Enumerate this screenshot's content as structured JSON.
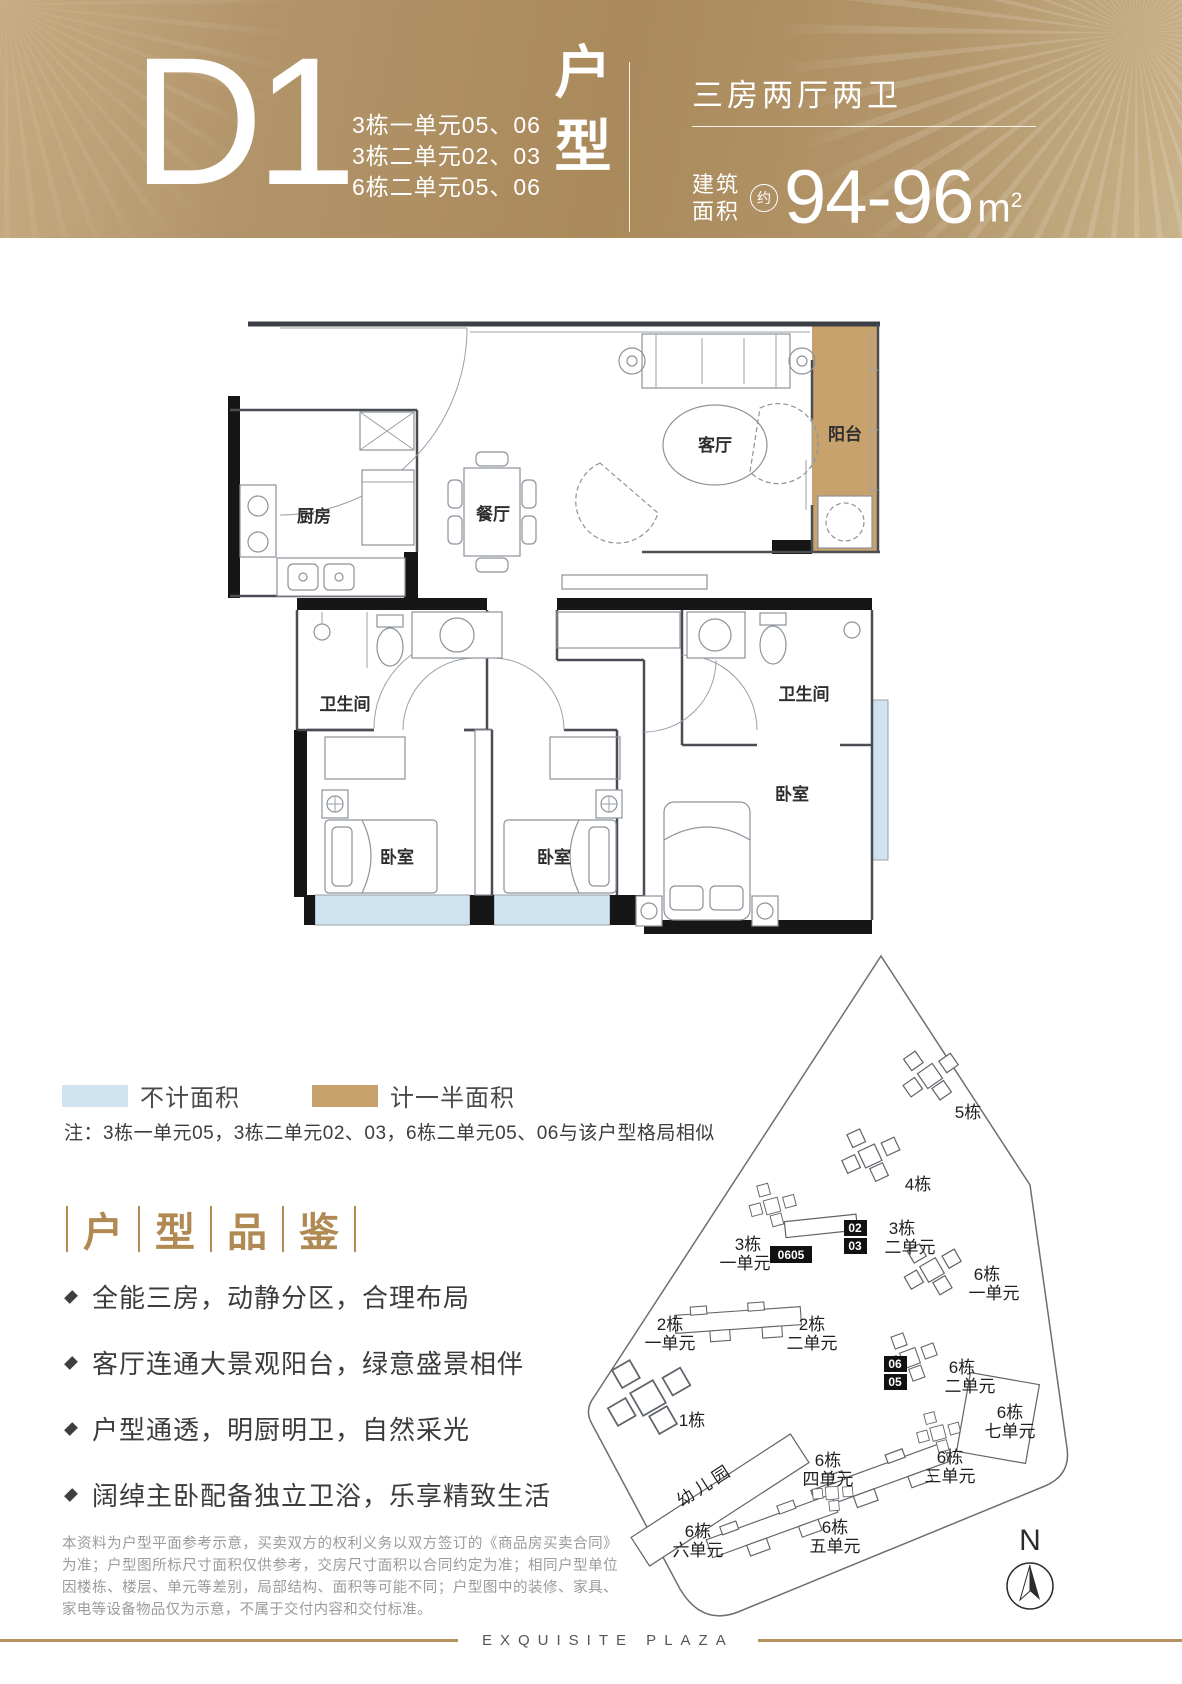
{
  "header": {
    "plan_code": "D1",
    "unit_lines": [
      "3栋一单元05、06",
      "3栋二单元02、03",
      "6栋二单元05、06"
    ],
    "category_char1": "户",
    "category_char2": "型",
    "layout_summary": "三房两厅两卫",
    "area_label_top": "建筑",
    "area_label_bottom": "面积",
    "area_circa": "约",
    "area_value": "94-96",
    "area_unit": "m",
    "area_sup": "2"
  },
  "colors": {
    "header_gold": "#b2946a",
    "legend_blue": "#cfe4f0",
    "legend_tan": "#c8a26c",
    "accent_gold_text": "#b08a52",
    "footer_line": "#b5915e"
  },
  "floor_plan": {
    "rooms": {
      "kitchen": "厨房",
      "dining": "餐厅",
      "living": "客厅",
      "balcony": "阳台",
      "bathroom": "卫生间",
      "bedroom": "卧室"
    }
  },
  "legend": {
    "items": [
      {
        "label": "不计面积",
        "color": "#cfe4f0"
      },
      {
        "label": "计一半面积",
        "color": "#c8a26c"
      }
    ],
    "note": "注：3栋一单元05，3栋二单元02、03，6栋二单元05、06与该户型格局相似"
  },
  "highlights": {
    "chars": [
      "户",
      "型",
      "品",
      "鉴"
    ],
    "bullets": [
      "全能三房，动静分区，合理布局",
      "客厅连通大景观阳台，绿意盛景相伴",
      "户型通透，明厨明卫，自然采光",
      "阔绰主卧配备独立卫浴，乐享精致生活"
    ]
  },
  "disclaimer": {
    "text": "本资料为户型平面参考示意，买卖双方的权利义务以双方签订的《商品房买卖合同》为准；户型图所标尺寸面积仅供参考，交房尺寸面积以合同约定为准；相同户型单位因楼栋、楼层、单元等差别，局部结构、面积等可能不同；户型图中的装修、家具、家电等设备物品仅为示意，不属于交付内容和交付标准。"
  },
  "site_map": {
    "labels": [
      {
        "building": "5栋",
        "unit": ""
      },
      {
        "building": "4栋",
        "unit": ""
      },
      {
        "building": "3栋",
        "unit": "一单元",
        "badge": "0605"
      },
      {
        "building": "3栋",
        "unit": "二单元",
        "badge_top": "02",
        "badge_bottom": "03"
      },
      {
        "building": "6栋",
        "unit": "一单元"
      },
      {
        "building": "2栋",
        "unit": "一单元"
      },
      {
        "building": "2栋",
        "unit": "二单元"
      },
      {
        "building": "6栋",
        "unit": "二单元",
        "badge_top": "06",
        "badge_bottom": "05"
      },
      {
        "building": "1栋",
        "unit": ""
      },
      {
        "building": "幼儿园",
        "unit": ""
      },
      {
        "building": "6栋",
        "unit": "四单元"
      },
      {
        "building": "6栋",
        "unit": "三单元"
      },
      {
        "building": "6栋",
        "unit": "七单元"
      },
      {
        "building": "6栋",
        "unit": "五单元"
      },
      {
        "building": "6栋",
        "unit": "六单元"
      }
    ],
    "compass": "N"
  },
  "footer": {
    "brand": "EXQUISITE PLAZA"
  }
}
